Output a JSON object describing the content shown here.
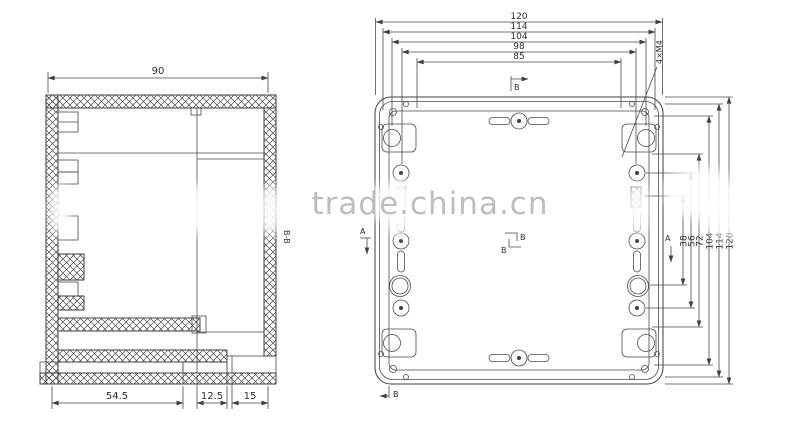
{
  "colors": {
    "background": "#ffffff",
    "line": "#3f3f3f",
    "dimension_text": "#2f2f2f",
    "watermark": "#b8b8b8"
  },
  "watermark": {
    "text": "trade.china.cn"
  },
  "left_view": {
    "section_label": "B-B",
    "dim_top": "90",
    "dims_bottom": [
      "54.5",
      "12.5",
      "15"
    ]
  },
  "right_view": {
    "thread_callout": "4×M4",
    "dims_top": [
      "120",
      "114",
      "104",
      "98",
      "85"
    ],
    "dims_right": [
      "120",
      "114",
      "104",
      "72",
      "56",
      "38"
    ],
    "marks": {
      "a_left": "A",
      "a_right": "A",
      "b_top": "B",
      "b_center_upper": "B",
      "b_center_lower": "B",
      "b_bottom": "B"
    }
  }
}
